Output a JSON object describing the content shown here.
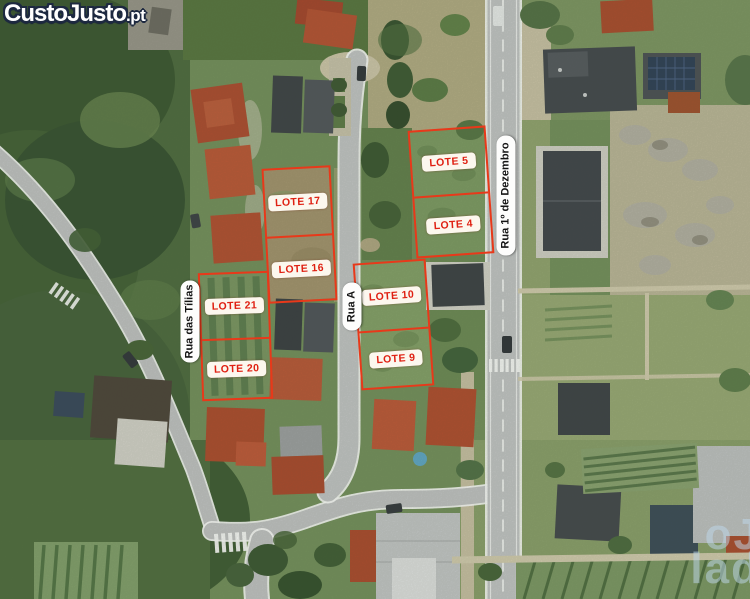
{
  "branding": {
    "logo_text": "CustoJusto",
    "logo_suffix": ".pt"
  },
  "watermark": {
    "line1": "oJ",
    "line2": "lad"
  },
  "streets": [
    {
      "id": "rua-das-tilias",
      "name": "Rua das Tílias"
    },
    {
      "id": "rua-a",
      "name": "Rua A"
    },
    {
      "id": "rua-1-de-dezembro",
      "name": "Rua 1º de Dezembro"
    }
  ],
  "lot_blocks": [
    {
      "id": "block-17-16",
      "lots": [
        {
          "label": "LOTE 17"
        },
        {
          "label": "LOTE 16"
        }
      ]
    },
    {
      "id": "block-21-20",
      "lots": [
        {
          "label": "LOTE 21"
        },
        {
          "label": "LOTE 20"
        }
      ]
    },
    {
      "id": "block-5-4",
      "lots": [
        {
          "label": "LOTE 5"
        },
        {
          "label": "LOTE 4"
        }
      ]
    },
    {
      "id": "block-10-9",
      "lots": [
        {
          "label": "LOTE 10"
        },
        {
          "label": "LOTE 9"
        }
      ]
    }
  ],
  "colors": {
    "lot_outline": "#e8391a",
    "lot_label_text": "#df2012",
    "lot_label_bg": "#fcf7ee",
    "street_label_bg": "#fdfdfc",
    "street_label_text": "#151515",
    "logo_fill": "#ffffff",
    "logo_outline": "#1d2940"
  }
}
